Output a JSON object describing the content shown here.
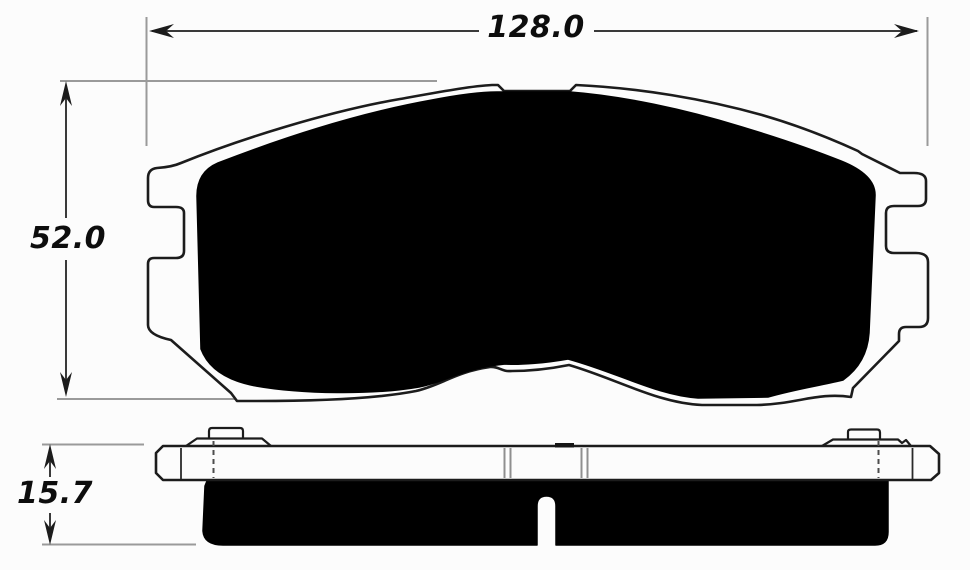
{
  "drawing": {
    "dimensions": {
      "width": {
        "label": "128.0"
      },
      "height": {
        "label": "52.0"
      },
      "thickness": {
        "label": "15.7"
      }
    },
    "colors": {
      "background": "#fcfcfc",
      "outline": "#1c1c1c",
      "friction_fill": "#000000",
      "dimension_line": "#3a3a3a",
      "extension_line": "#9a9a9a",
      "label_text": "#0d0d0d"
    }
  }
}
